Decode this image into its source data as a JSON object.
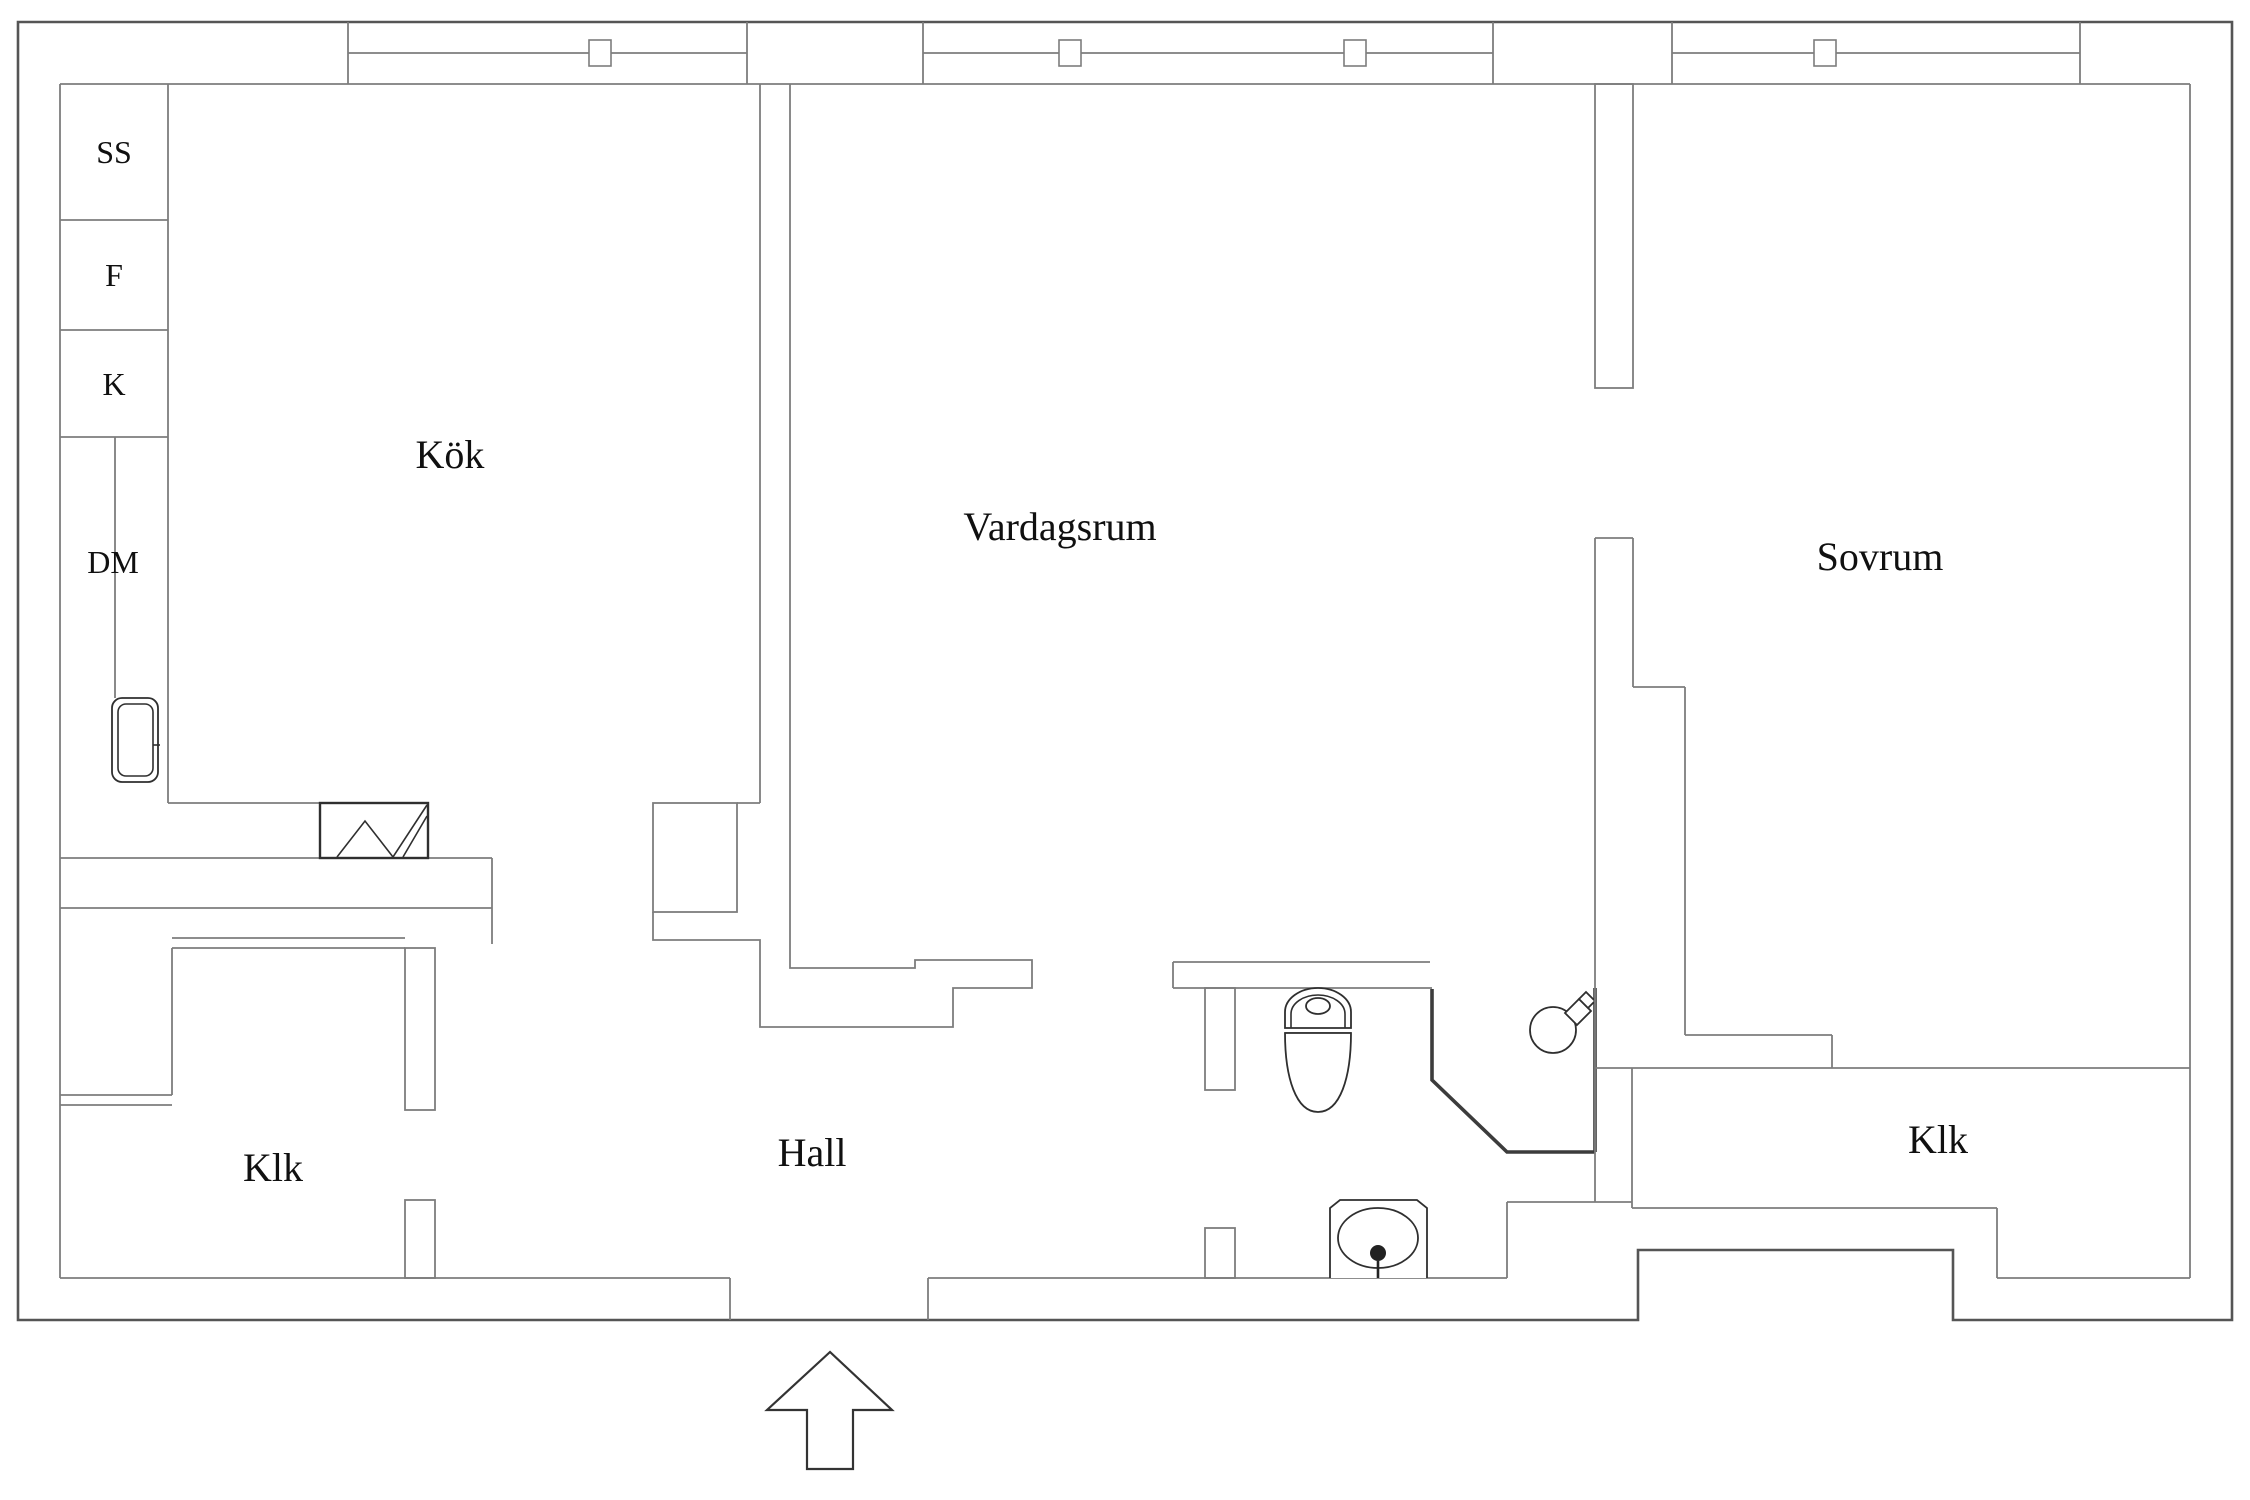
{
  "plan": {
    "title": "Apartment floor plan",
    "rooms": {
      "kitchen": {
        "label": "Kök"
      },
      "living_room": {
        "label": "Vardagsrum"
      },
      "bedroom": {
        "label": "Sovrum"
      },
      "hall": {
        "label": "Hall"
      },
      "closet_left": {
        "label": "Klk"
      },
      "closet_right": {
        "label": "Klk"
      }
    },
    "appliances": {
      "ss": {
        "label": "SS"
      },
      "f": {
        "label": "F"
      },
      "k": {
        "label": "K"
      },
      "dm": {
        "label": "DM"
      }
    },
    "icons": {
      "entrance_arrow": "entrance-arrow-icon",
      "kitchen_sink": "kitchen-sink-icon",
      "stove": "stove-icon",
      "toilet": "toilet-icon",
      "shower": "shower-icon",
      "washbasin": "washbasin-icon",
      "window_mullions": 4
    },
    "colors": {
      "background": "#ffffff",
      "outer_wall_line": "#555555",
      "inner_wall_line": "#7d7d7d",
      "fixture_line": "#2f2f2f",
      "text": "#101010"
    }
  }
}
